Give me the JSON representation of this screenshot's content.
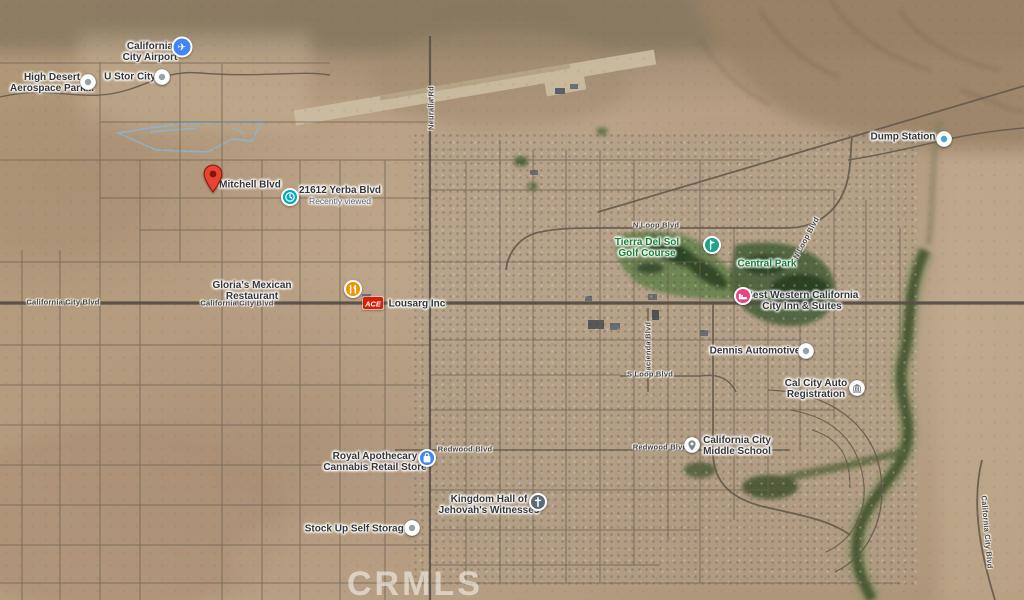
{
  "map": {
    "watermark": "CRMLS",
    "road_labels": [
      {
        "id": "california-city-blvd-w",
        "text": "California City Blvd",
        "x": 63,
        "y": 302,
        "rotate": 0
      },
      {
        "id": "california-city-blvd-c",
        "text": "California City Blvd",
        "x": 237,
        "y": 303,
        "rotate": 0
      },
      {
        "id": "neuralia-rd",
        "text": "Neuralia Rd",
        "x": 431,
        "y": 108,
        "rotate": -90
      },
      {
        "id": "n-loop-blvd-w",
        "text": "N Loop Blvd",
        "x": 656,
        "y": 225,
        "rotate": 0
      },
      {
        "id": "n-loop-blvd-e",
        "text": "N Loop Blvd",
        "x": 806,
        "y": 238,
        "rotate": -62
      },
      {
        "id": "hacienda-blvd",
        "text": "Hacienda Blvd",
        "x": 648,
        "y": 349,
        "rotate": -90
      },
      {
        "id": "s-loop-blvd",
        "text": "S Loop Blvd",
        "x": 650,
        "y": 374,
        "rotate": 0
      },
      {
        "id": "redwood-blvd-w",
        "text": "Redwood Blvd",
        "x": 465,
        "y": 449,
        "rotate": 0
      },
      {
        "id": "redwood-blvd-e",
        "text": "Redwood Blvd",
        "x": 660,
        "y": 447,
        "rotate": 0
      },
      {
        "id": "california-city-blvd-se",
        "text": "California City Blvd",
        "x": 987,
        "y": 532,
        "rotate": 85
      }
    ],
    "poi_labels": [
      {
        "id": "california-city-airport",
        "text": "California\nCity Airport",
        "x": 150,
        "y": 52
      },
      {
        "id": "high-desert-aerospace-park",
        "text": "High Desert\nAerospace Park...",
        "x": 52,
        "y": 83
      },
      {
        "id": "u-stor-city",
        "text": "U Stor City",
        "x": 130,
        "y": 77
      },
      {
        "id": "mitchell-blvd",
        "text": "Mitchell Blvd",
        "x": 250,
        "y": 185
      },
      {
        "id": "yerba-blvd-21612",
        "text": "21612 Yerba Blvd",
        "sub": "Recently viewed",
        "x": 340,
        "y": 196
      },
      {
        "id": "glorias-mexican-restaurant",
        "text": "Gloria's Mexican\nRestaurant",
        "x": 252,
        "y": 291
      },
      {
        "id": "lousarg-inc",
        "text": "Lousarg Inc",
        "x": 417,
        "y": 304
      },
      {
        "id": "tierra-del-sol-golf-course",
        "text": "Tierra Del Sol\nGolf Course",
        "color": "green",
        "x": 647,
        "y": 248
      },
      {
        "id": "central-park",
        "text": "Central Park",
        "color": "green",
        "x": 767,
        "y": 264
      },
      {
        "id": "best-western-california-city-inn",
        "text": "Best Western California\nCity Inn & Suites",
        "x": 802,
        "y": 301
      },
      {
        "id": "dennis-automotive",
        "text": "Dennis Automotive",
        "x": 755,
        "y": 351
      },
      {
        "id": "cal-city-auto-registration",
        "text": "Cal City Auto\nRegistration",
        "x": 816,
        "y": 389
      },
      {
        "id": "california-city-middle-school",
        "text": "California City\nMiddle School",
        "x": 737,
        "y": 446
      },
      {
        "id": "royal-apothecary-cannabis",
        "text": "Royal Apothecary\nCannabis Retail Store",
        "x": 375,
        "y": 462
      },
      {
        "id": "kingdom-hall-jehovahs-witnesses",
        "text": "Kingdom Hall of\nJehovah's Witnesses",
        "x": 489,
        "y": 505
      },
      {
        "id": "stock-up-self-storage",
        "text": "Stock Up Self Storage",
        "x": 357,
        "y": 529
      },
      {
        "id": "dump-station",
        "text": "Dump Station",
        "x": 903,
        "y": 137
      }
    ],
    "markers": [
      {
        "id": "airport",
        "type": "airport",
        "x": 182,
        "y": 47,
        "color": "#4285F4"
      },
      {
        "id": "aerospace-park",
        "type": "dot",
        "x": 88,
        "y": 82,
        "color": "#9aa0a6"
      },
      {
        "id": "u-stor-city",
        "type": "dot",
        "x": 162,
        "y": 77,
        "color": "#9aa0a6"
      },
      {
        "id": "subject-property-pin",
        "type": "pin",
        "x": 213,
        "y": 188,
        "color": "#EA4335"
      },
      {
        "id": "recently-viewed",
        "type": "clock",
        "x": 290,
        "y": 197,
        "color": "#00A8C0"
      },
      {
        "id": "restaurant",
        "type": "restaurant",
        "x": 353,
        "y": 289,
        "color": "#F09300"
      },
      {
        "id": "ace-logo",
        "type": "logo",
        "x": 373,
        "y": 303,
        "color": "#D81E05",
        "text": "ACE"
      },
      {
        "id": "golf-course",
        "type": "golf",
        "x": 712,
        "y": 245,
        "color": "#20A189"
      },
      {
        "id": "hotel",
        "type": "hotel",
        "x": 743,
        "y": 296,
        "color": "#E9427E"
      },
      {
        "id": "dennis-automotive",
        "type": "dot",
        "x": 806,
        "y": 351,
        "color": "#9aa0a6"
      },
      {
        "id": "auto-registration",
        "type": "bank",
        "x": 857,
        "y": 388,
        "color": "#7d838a"
      },
      {
        "id": "middle-school",
        "type": "place",
        "x": 692,
        "y": 445,
        "color": "#7d838a"
      },
      {
        "id": "cannabis-store",
        "type": "bag",
        "x": 427,
        "y": 458,
        "color": "#4285F4"
      },
      {
        "id": "kingdom-hall",
        "type": "church",
        "x": 538,
        "y": 502,
        "color": "#5C6B73"
      },
      {
        "id": "self-storage",
        "type": "dot",
        "x": 412,
        "y": 528,
        "color": "#9aa0a6"
      },
      {
        "id": "dump-station",
        "type": "dot",
        "x": 944,
        "y": 139,
        "color": "#4AA3DF"
      }
    ]
  }
}
